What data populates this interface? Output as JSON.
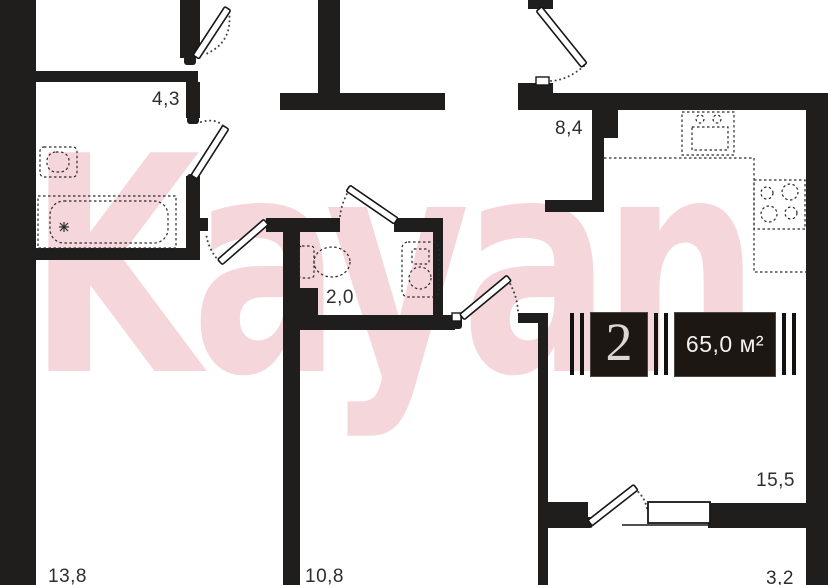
{
  "plan": {
    "watermark_text": "Kayan",
    "badge": {
      "room_count": "2",
      "total_area": "65,0 м²"
    },
    "room_labels": {
      "bathroom": "4,3",
      "hallway": "8,4",
      "wc": "2,0",
      "bedroom_left": "13,8",
      "room_center": "10,8",
      "living_room": "15,5",
      "balcony": "3,2"
    }
  }
}
